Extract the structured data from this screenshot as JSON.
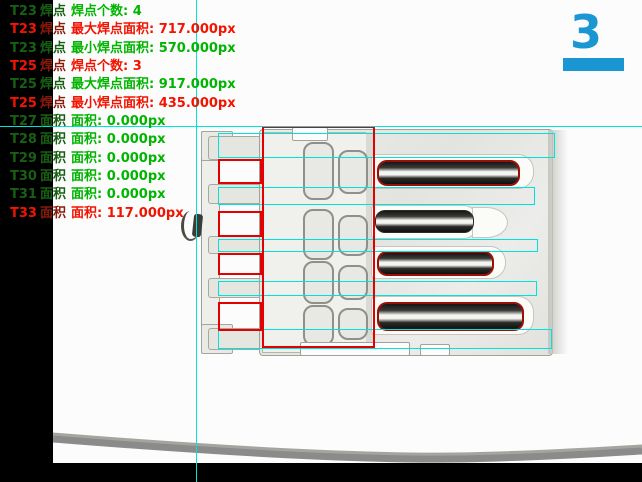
{
  "counter": {
    "value": "3"
  },
  "results": {
    "lines": [
      {
        "tool": "T23",
        "category": "焊点",
        "message": "焊点个数: 4",
        "status": "pass"
      },
      {
        "tool": "T23",
        "category": "焊点",
        "message": "最大焊点面积: 717.000px",
        "status": "fail"
      },
      {
        "tool": "T23",
        "category": "焊点",
        "message": "最小焊点面积: 570.000px",
        "status": "pass"
      },
      {
        "tool": "T25",
        "category": "焊点",
        "message": "焊点个数: 3",
        "status": "fail"
      },
      {
        "tool": "T25",
        "category": "焊点",
        "message": "最大焊点面积: 917.000px",
        "status": "pass"
      },
      {
        "tool": "T25",
        "category": "焊点",
        "message": "最小焊点面积: 435.000px",
        "status": "fail"
      },
      {
        "tool": "T27",
        "category": "面积",
        "message": "面积: 0.000px",
        "status": "pass"
      },
      {
        "tool": "T28",
        "category": "面积",
        "message": "面积: 0.000px",
        "status": "pass"
      },
      {
        "tool": "T29",
        "category": "面积",
        "message": "面积: 0.000px",
        "status": "pass"
      },
      {
        "tool": "T30",
        "category": "面积",
        "message": "面积: 0.000px",
        "status": "pass"
      },
      {
        "tool": "T31",
        "category": "面积",
        "message": "面积: 0.000px",
        "status": "pass"
      },
      {
        "tool": "T33",
        "category": "面积",
        "message": "面积: 117.000px",
        "status": "fail"
      }
    ]
  },
  "regions": {
    "cyan_bands": [
      {
        "x": 218,
        "y": 133,
        "w": 335,
        "h": 23
      },
      {
        "x": 218,
        "y": 187,
        "w": 315,
        "h": 16
      },
      {
        "x": 218,
        "y": 239,
        "w": 318,
        "h": 11
      },
      {
        "x": 218,
        "y": 281,
        "w": 317,
        "h": 13
      },
      {
        "x": 218,
        "y": 329,
        "w": 332,
        "h": 18
      }
    ],
    "red_boxes": [
      {
        "x": 262,
        "y": 126,
        "w": 109,
        "h": 218
      },
      {
        "x": 218,
        "y": 159,
        "w": 40,
        "h": 21
      },
      {
        "x": 218,
        "y": 211,
        "w": 40,
        "h": 22
      },
      {
        "x": 218,
        "y": 253,
        "w": 40,
        "h": 18
      },
      {
        "x": 218,
        "y": 302,
        "w": 40,
        "h": 25
      }
    ]
  },
  "colors": {
    "pass": "#00b400",
    "pass_dim": "#176012",
    "fail": "#f21300",
    "fail_dim": "#8a1a0a",
    "crosshair_cyan": "#00e3dc",
    "roi_red": "#e30000",
    "counter_blue": "#1a96d3"
  }
}
